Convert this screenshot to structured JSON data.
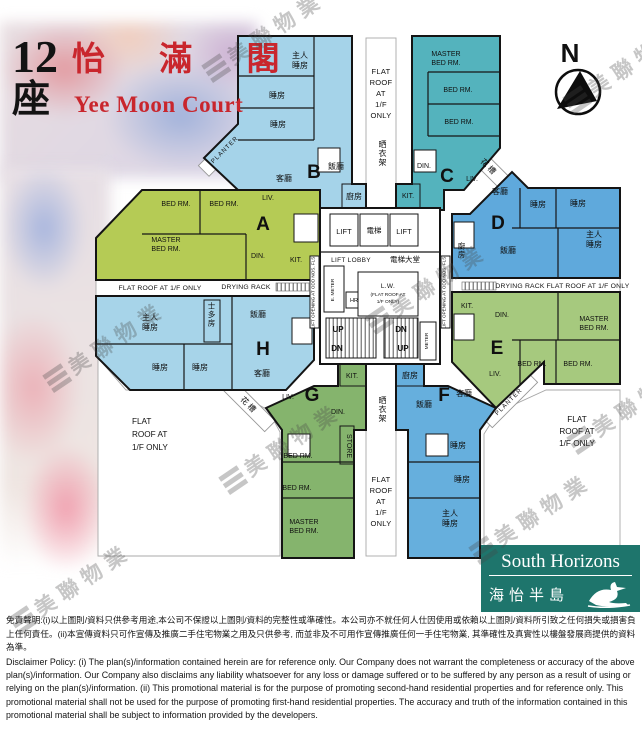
{
  "title": {
    "block_no": "12",
    "block_word": "座",
    "name_cn": "怡 滿 閣",
    "name_en": "Yee Moon Court"
  },
  "compass": {
    "label": "N"
  },
  "watermark": {
    "brand": "美聯物業"
  },
  "colors": {
    "unit_a": "#b5cb55",
    "unit_b": "#a5d3e9",
    "unit_c": "#54b3bd",
    "unit_d": "#5fa9dc",
    "unit_e": "#a6c97e",
    "unit_f": "#66afdd",
    "unit_g": "#85b46d",
    "unit_h": "#a7d4e9",
    "logo_teal": "#1e756c",
    "title_red": "#c9262d"
  },
  "units": {
    "a": {
      "letter": "A",
      "bed1": "BED RM.",
      "bed2": "BED RM.",
      "master_l1": "MASTER",
      "master_l2": "BED RM.",
      "liv": "LIV.",
      "din": "DIN.",
      "kit": "KIT."
    },
    "b": {
      "letter": "B",
      "master_l1": "主人",
      "master_l2": "睡房",
      "bed1": "睡房",
      "bed2": "睡房",
      "liv": "客廳",
      "din": "飯廳",
      "kit": "廚房"
    },
    "c": {
      "letter": "C",
      "master_l1": "MASTER",
      "master_l2": "BED RM.",
      "bed1": "BED RM.",
      "bed2": "BED RM.",
      "liv": "LIV.",
      "din": "DIN.",
      "kit": "KIT."
    },
    "d": {
      "letter": "D",
      "liv": "客廳",
      "bed1": "睡房",
      "bed2": "睡房",
      "master_l1": "主人",
      "master_l2": "睡房",
      "din": "飯廳",
      "kit": "廚房"
    },
    "e": {
      "letter": "E",
      "kit": "KIT.",
      "din": "DIN.",
      "master_l1": "MASTER",
      "master_l2": "BED RM.",
      "bed1": "BED RM.",
      "bed2": "BED RM.",
      "liv": "LIV."
    },
    "f": {
      "letter": "F",
      "din": "飯廳",
      "liv": "客廳",
      "kit": "廚房",
      "bed1": "睡房",
      "bed2": "睡房",
      "master_l1": "主人",
      "master_l2": "睡房"
    },
    "g": {
      "letter": "G",
      "kit": "KIT.",
      "din": "DIN.",
      "liv": "LIV.",
      "store": "STORE",
      "bed1": "BED RM.",
      "bed2": "BED RM.",
      "master_l1": "MASTER",
      "master_l2": "BED RM."
    },
    "h": {
      "letter": "H",
      "master_l1": "主人",
      "master_l2": "睡房",
      "din": "飯廳",
      "liv": "客廳",
      "store": "士多房",
      "bed1": "睡房",
      "bed2": "睡房"
    }
  },
  "core": {
    "lift": "LIFT",
    "lift_cn": "電梯",
    "lobby_en": "LIFT LOBBY",
    "lobby_cn": "電梯大堂",
    "lift_opening": "LIFT OPENING AT ODD NOS. FLS.",
    "e_meter": "E. METER",
    "hr": "HR",
    "lw_l1": "L.W.",
    "lw_l2": "(FLAT ROOF AT",
    "lw_l3": "1/F ONLY)",
    "up": "UP",
    "dn": "DN",
    "meter": "METER"
  },
  "outdoor": {
    "flat_roof_line": "FLAT ROOF AT 1/F ONLY",
    "fr_l1": "FLAT",
    "fr_l2": "ROOF",
    "fr_l3": "AT",
    "fr_l4": "1/F",
    "fr_l5": "ONLY",
    "fr3_l1": "FLAT",
    "fr3_l2": "ROOF AT",
    "fr3_l3": "1/F ONLY",
    "drying_rack_en": "DRYING RACK",
    "drying_rack_cn": "晒衣架",
    "planter_en": "PLANTER",
    "planter_cn": "花槽"
  },
  "logo": {
    "name_en": "South Horizons",
    "name_cn": "海怡半島"
  },
  "disclaimer": {
    "cn": "免責聲明:(i)以上圖則/資料只供參考用途,本公司不保證以上圖則/資料的完整性或準確性。本公司亦不就任何人仕因使用或依賴以上圖則/資料所引致之任何損失或損害負上任何責任。(ii)本宣傳資料只可作宣傳及推廣二手住宅物業之用及只供參考, 而並非及不可用作宣傳推廣任何一手住宅物業, 其準確性及真實性以樓盤發展商提供的資料為準。",
    "en": "Disclaimer Policy: (i) The plan(s)/information contained herein are for reference only. Our Company does not warrant the completeness or accuracy of the above plan(s)/information. Our Company also disclaims any liability whatsoever for any loss or damage suffered or to be suffered by any person as a result of using or relying on the plan(s)/information. (ii) This promotional material is for the purpose of promoting second-hand residential properties and for reference only. This promotional material shall not be used for the purpose of promoting first-hand residential properties. The accuracy and truth of the information contained in this promotional material shall be subject to information provided by the developers."
  }
}
